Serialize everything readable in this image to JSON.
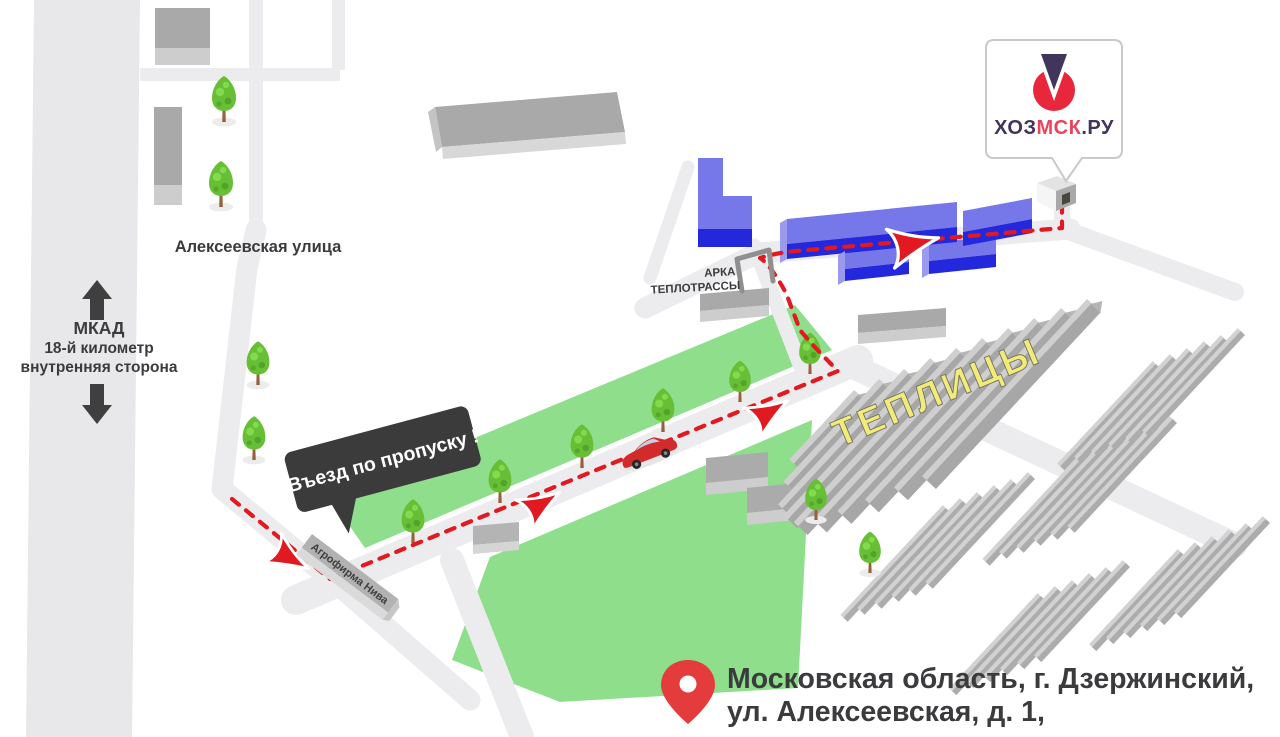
{
  "map": {
    "logo": {
      "text_part1": "ХОЗ",
      "text_part2": "МСК",
      "text_part3": ".РУ"
    },
    "labels": {
      "street": "Алексеевская улица",
      "mkad_title": "МКАД",
      "mkad_line2": "18-й километр",
      "mkad_line3": "внутренняя сторона",
      "arch_line1": "АРКА",
      "arch_line2": "ТЕПЛОТРАССЫ",
      "entry_sign": "Въезд по пропуску !",
      "agrofirm": "Агрофирма Нива",
      "greenhouses": "ТЕПЛИЦЫ"
    },
    "address": {
      "line1": "Московская область, г. Дзержинский,",
      "line2": "ул. Алексеевская, д. 1,"
    },
    "icons": {
      "logo": "hozmsk-logo-icon",
      "pin": "location-pin-icon",
      "tree": "tree-icon",
      "car": "car-icon",
      "route_arrow": "route-direction-arrow",
      "mkad_arrows": "two-way-traffic-arrows",
      "arch": "heat-pipe-arch-icon"
    },
    "colors": {
      "route_red": "#E01A20",
      "green_area": "#8FDE8C",
      "blue_roof": "#7678E9",
      "blue_front": "#2428DC",
      "blue_end": "#9A9AEF",
      "road_gray": "#ECECEE",
      "mkad_gray": "#E8E8EA",
      "sign_black": "#3B3B3B",
      "logo_red": "#E8273C",
      "logo_purple": "#42355C",
      "greenhouse_text_yellow": "#F2EB7C",
      "pin_red": "#E43B3C",
      "text_dark": "#3B3B3D"
    }
  }
}
